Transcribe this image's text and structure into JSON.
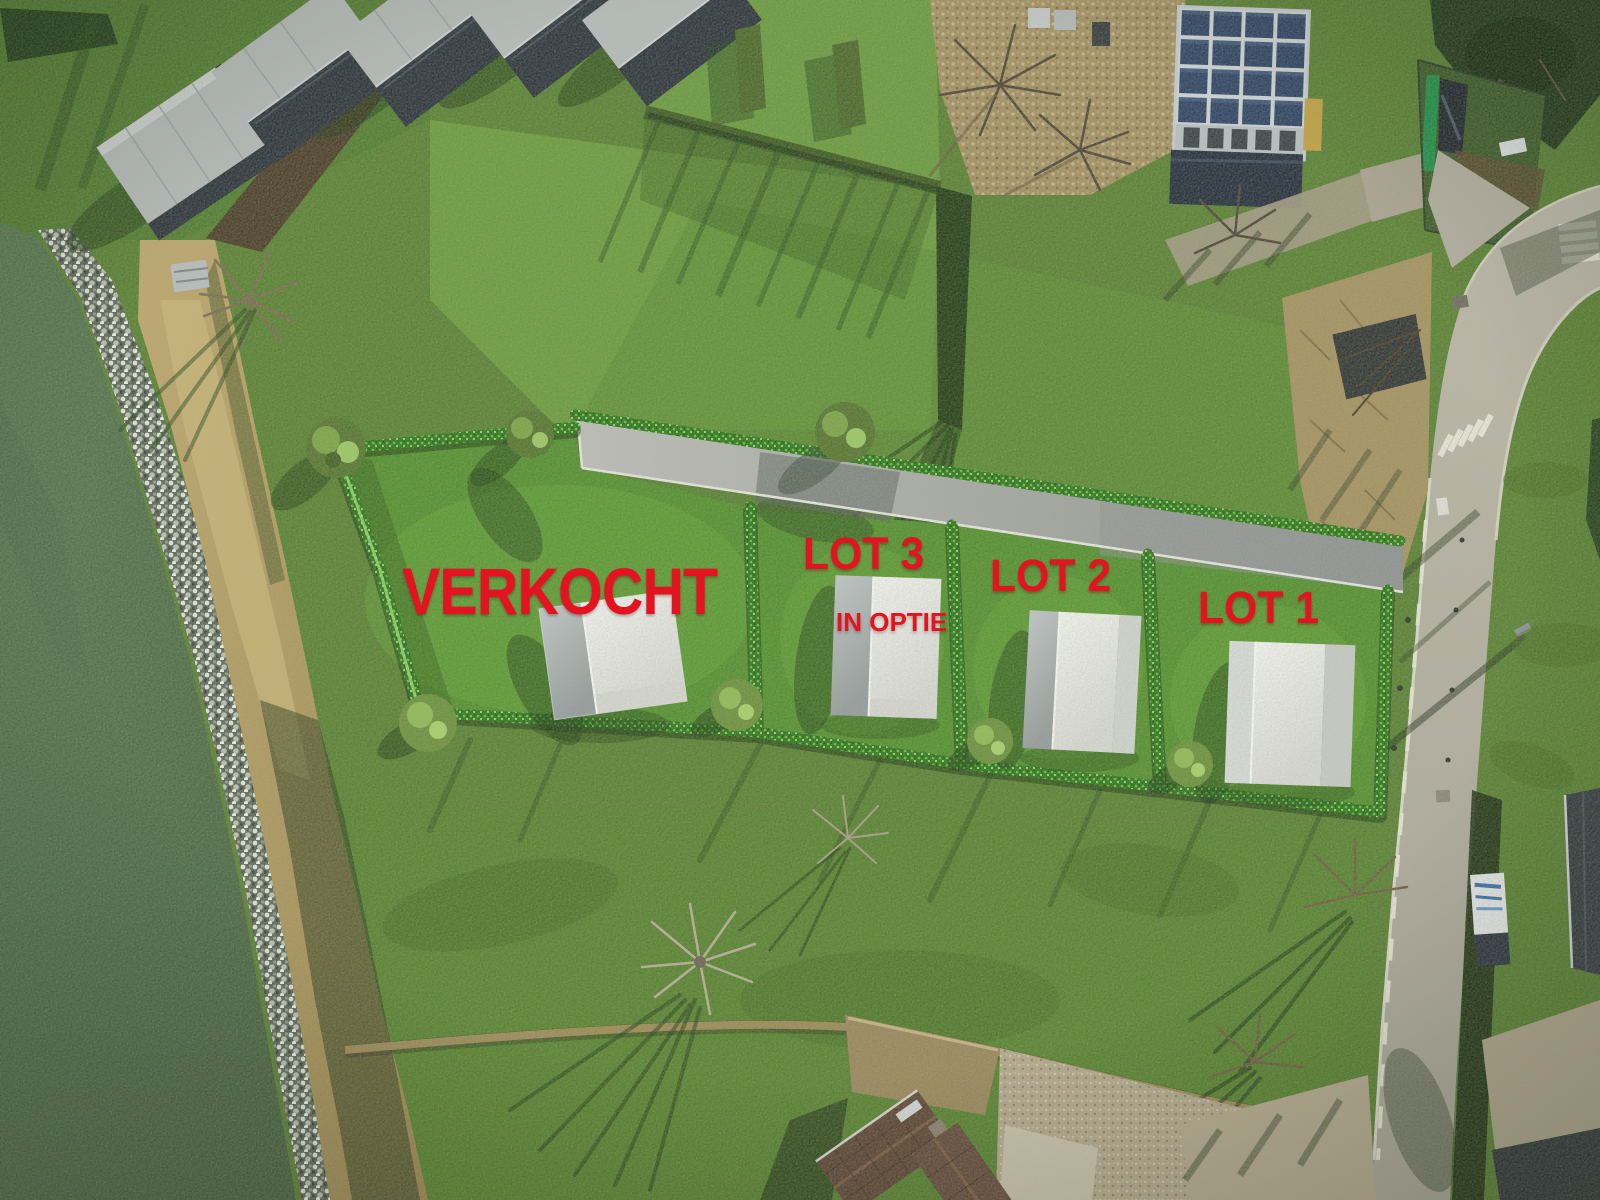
{
  "scene": {
    "kind": "aerial-site-plan-photo"
  },
  "annotations": {
    "verkocht": "VERKOCHT",
    "lot3": "LOT 3",
    "lot3_status": "IN OPTIE",
    "lot2": "LOT 2",
    "lot1": "LOT 1"
  },
  "lots": [
    {
      "name": "lot-verkocht",
      "label": "VERKOCHT"
    },
    {
      "name": "lot-3",
      "label": "LOT 3",
      "status": "IN OPTIE"
    },
    {
      "name": "lot-2",
      "label": "LOT 2"
    },
    {
      "name": "lot-1",
      "label": "LOT 1"
    }
  ],
  "colors": {
    "label_red": "#e3141f",
    "hedge_green": "#2e741c",
    "lot_grass": "#528e2c",
    "field_grass": "#587f31",
    "water": "#52714d",
    "road_gray": "#b3aea1",
    "driveway_gray": "#a9aaa6",
    "house_white": "#f0f0ee",
    "house_shade": "#a9aeb0",
    "tent_dark": "#2a313a",
    "tent_light": "#b6babc",
    "solar_panel_blue": "#2c4064"
  }
}
